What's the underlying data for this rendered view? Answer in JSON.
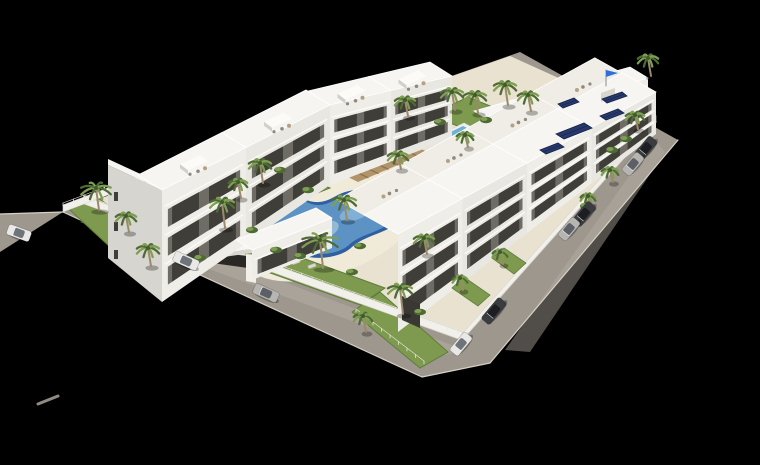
{
  "scene": {
    "canvas": {
      "w": 760,
      "h": 465
    },
    "palette": {
      "background": "#000000",
      "road": "#9e978e",
      "roadLight": "#b4ada3",
      "curb": "#d6d0c4",
      "deck": "#e9e2d1",
      "deckLight": "#f0ead9",
      "lawn": "#7e9a4f",
      "lawnDark": "#5f7c3c",
      "bldgTop": "#f6f5f1",
      "bldgFaceA": "#efede7",
      "bldgFaceB": "#e9e7e1",
      "bldgSide": "#d7d5cf",
      "recess": "#6e6c65",
      "window": "#3f3e39",
      "slab": "#fbfaf7",
      "capTop": "#fcfbf8",
      "capSide": "#d2d0ca",
      "wallWhite": "#f2f0ea",
      "wallEdge": "#d9d6cf",
      "poolRim": "#2e5fa3",
      "poolWater": "#5d93c4",
      "poolShallow": "#9cc0d6",
      "poolGlint": "#86b4d6",
      "smallPoolWater": "#6fb0d4",
      "smallPoolDeck": "#eef0ef",
      "wood": "#b2946a",
      "woodDark": "#8d7350",
      "palmDark": "#4e6b35",
      "palmLight": "#7f9e52",
      "palmCore": "#3f5a2c",
      "trunk": "#9b8a6a",
      "furnGray": "#8f8a80",
      "furnTan": "#b3a184",
      "lounger": "#ddd8cc",
      "loungerEdge": "#a8a297",
      "panel": "#27386b",
      "panelEdge": "#16224a",
      "flag": "#2f6fd6",
      "pole": "#8a8a8a",
      "carWhite": "#e8e8e6",
      "carSilver": "#b6b5b1",
      "carDark": "#3b3c3f",
      "cabinWhite": "#6f747a",
      "cabinSilver": "#5c6066",
      "cabinDark": "#1c1e22",
      "shadow": "rgba(0,0,0,0.28)",
      "gateShadow": "#2a2825",
      "garage": "#3a3833",
      "fence": "#e8e6df",
      "strayMark": "#908a82",
      "speck": "#cfcac2"
    },
    "ground": {
      "mainRoad": [
        [
          63,
          212
        ],
        [
          520,
          52
        ],
        [
          678,
          140
        ],
        [
          490,
          363
        ],
        [
          422,
          377
        ]
      ],
      "leftRoadExt": [
        [
          63,
          212
        ],
        [
          0,
          214
        ],
        [
          0,
          252
        ]
      ],
      "frontRoadSheen": [
        [
          80,
          222
        ],
        [
          445,
          355
        ],
        [
          465,
          350
        ],
        [
          100,
          213
        ]
      ],
      "rightRoadSheen": [
        [
          655,
          140
        ],
        [
          505,
          350
        ],
        [
          530,
          352
        ],
        [
          665,
          152
        ]
      ],
      "site": [
        [
          84,
          204
        ],
        [
          510,
          56
        ],
        [
          656,
          122
        ],
        [
          462,
          340
        ]
      ],
      "curbs": [
        [
          [
            63,
            212
          ],
          [
            422,
            377
          ]
        ],
        [
          [
            84,
            204
          ],
          [
            462,
            340
          ]
        ],
        [
          [
            678,
            140
          ],
          [
            490,
            363
          ]
        ],
        [
          [
            656,
            122
          ],
          [
            462,
            340
          ]
        ],
        [
          [
            422,
            377
          ],
          [
            490,
            363
          ]
        ],
        [
          [
            0,
            214
          ],
          [
            63,
            212
          ]
        ]
      ],
      "strayDash": [
        [
          38,
          404
        ],
        [
          58,
          396
        ]
      ],
      "speck": [
        157,
        281
      ]
    },
    "poolDeckEllipse": {
      "cx": 330,
      "cy": 226,
      "rx": 95,
      "ry": 48,
      "rot": -20
    },
    "mainPool": {
      "rimPath": "M 262,212 C 268,198 288,192 304,199 C 315,204 324,203 336,196 C 352,186 382,188 396,200 C 406,209 402,222 388,229 C 376,235 362,238 352,247 C 342,257 318,261 300,255 C 282,249 256,232 262,212 Z",
      "waterScale": 0.88,
      "center": [
        330,
        226
      ],
      "shallow": {
        "cx": 310,
        "cy": 234,
        "rx": 30,
        "ry": 11,
        "rot": -18
      },
      "glint": {
        "cx": 355,
        "cy": 213,
        "rx": 16,
        "ry": 7,
        "rot": -18
      }
    },
    "smallPool": {
      "deck": [
        [
          431,
          139
        ],
        [
          464,
          123
        ],
        [
          489,
          136
        ],
        [
          456,
          152
        ]
      ],
      "water": [
        [
          436,
          139
        ],
        [
          463,
          126
        ],
        [
          484,
          136
        ],
        [
          457,
          149
        ]
      ]
    },
    "woodDeck": {
      "quad": [
        [
          330,
          168
        ],
        [
          400,
          140
        ],
        [
          428,
          152
        ],
        [
          358,
          182
        ]
      ],
      "stripes": 7
    },
    "pavilion": [
      [
        430,
        155
      ],
      [
        452,
        146
      ],
      [
        462,
        153
      ],
      [
        440,
        162
      ]
    ],
    "lawns": [
      [
        [
          70,
          210
        ],
        [
          162,
          295
        ],
        [
          192,
          268
        ],
        [
          92,
          193
        ]
      ],
      [
        [
          262,
          270
        ],
        [
          360,
          305
        ],
        [
          385,
          288
        ],
        [
          286,
          252
        ]
      ],
      [
        [
          352,
          312
        ],
        [
          420,
          368
        ],
        [
          448,
          352
        ],
        [
          380,
          292
        ]
      ],
      [
        [
          215,
          235
        ],
        [
          252,
          258
        ],
        [
          272,
          244
        ],
        [
          238,
          218
        ]
      ],
      [
        [
          248,
          180
        ],
        [
          300,
          200
        ],
        [
          330,
          188
        ],
        [
          278,
          166
        ]
      ],
      [
        [
          430,
          115
        ],
        [
          480,
          135
        ],
        [
          520,
          118
        ],
        [
          468,
          97
        ]
      ],
      [
        [
          600,
          150
        ],
        [
          650,
          128
        ],
        [
          640,
          120
        ],
        [
          592,
          142
        ]
      ]
    ],
    "patioLawns": [
      [
        [
          452,
          288
        ],
        [
          478,
          306
        ],
        [
          490,
          295
        ],
        [
          464,
          277
        ]
      ],
      [
        [
          492,
          258
        ],
        [
          514,
          274
        ],
        [
          526,
          263
        ],
        [
          504,
          248
        ]
      ]
    ],
    "walls": [
      {
        "quad": [
          [
            84,
            204
          ],
          [
            205,
            248
          ],
          [
            205,
            240
          ],
          [
            84,
            196
          ]
        ]
      },
      {
        "quad": [
          [
            258,
            267
          ],
          [
            462,
            340
          ],
          [
            462,
            332
          ],
          [
            258,
            259
          ]
        ]
      },
      {
        "quad": [
          [
            656,
            122
          ],
          [
            462,
            340
          ],
          [
            462,
            334
          ],
          [
            656,
            116
          ]
        ]
      },
      {
        "quad": [
          [
            63,
            212
          ],
          [
            200,
            160
          ],
          [
            200,
            153
          ],
          [
            63,
            205
          ]
        ]
      }
    ],
    "fences": [
      {
        "from": [
          84,
          198
        ],
        "to": [
          203,
          242
        ],
        "n": 12
      },
      {
        "from": [
          260,
          261
        ],
        "to": [
          458,
          333
        ],
        "n": 19
      },
      {
        "from": [
          63,
          206
        ],
        "to": [
          198,
          155
        ],
        "n": 13
      },
      {
        "from": [
          356,
          312
        ],
        "to": [
          424,
          364
        ],
        "n": 8
      }
    ],
    "entranceGate": {
      "shadow": [
        [
          212,
          252
        ],
        [
          248,
          256
        ],
        [
          248,
          268
        ],
        [
          212,
          263
        ]
      ],
      "rightLeg": [
        [
          246,
          254
        ],
        [
          256,
          255
        ],
        [
          256,
          283
        ],
        [
          246,
          281
        ]
      ],
      "leftLeg": [
        [
          206,
          248
        ],
        [
          211,
          248
        ],
        [
          211,
          266
        ],
        [
          206,
          265
        ]
      ],
      "roofTop": [
        [
          204,
          242
        ],
        [
          252,
          236
        ],
        [
          265,
          247
        ],
        [
          217,
          254
        ]
      ],
      "roofEdge": [
        [
          217,
          254
        ],
        [
          265,
          247
        ],
        [
          265,
          251
        ],
        [
          217,
          258
        ]
      ],
      "vents": [
        [
          231,
          246
        ],
        [
          241,
          244
        ]
      ]
    },
    "leftGableEnd": {
      "wall": [
        [
          108,
          258
        ],
        [
          162,
          302
        ],
        [
          162,
          190
        ],
        [
          108,
          165
        ]
      ],
      "roofSliver": [
        [
          108,
          165
        ],
        [
          162,
          190
        ],
        [
          162,
          184
        ],
        [
          108,
          159
        ]
      ],
      "windows": [
        [
          114,
          192
        ],
        [
          114,
          222
        ],
        [
          114,
          250
        ]
      ]
    },
    "rows": [
      {
        "name": "apartment-row-back",
        "x0": 492,
        "y0": 172,
        "x1": 648,
        "y1": 112,
        "h0": 50,
        "h1": 34,
        "sections": 3,
        "rdx": -18,
        "rdy": -11,
        "floors": 2,
        "gabled": true,
        "terrace": false
      },
      {
        "name": "apartment-row-left-a",
        "x0": 162,
        "y0": 302,
        "x1": 330,
        "y1": 185,
        "h0": 112,
        "h1": 80,
        "sections": 2,
        "rdx": -24,
        "rdy": -15,
        "floors": 3,
        "gabled": true,
        "terrace": false
      },
      {
        "name": "apartment-row-left-b",
        "x0": 330,
        "y0": 185,
        "x1": 452,
        "y1": 138,
        "h0": 80,
        "h1": 62,
        "sections": 2,
        "rdx": -22,
        "rdy": -14,
        "floors": 3,
        "gabled": true,
        "terrace": false
      },
      {
        "name": "front-low-block",
        "x0": 252,
        "y0": 280,
        "x1": 332,
        "y1": 248,
        "h0": 30,
        "h1": 30,
        "sections": 1,
        "rdx": -16,
        "rdy": -10,
        "floors": 1,
        "gabled": false,
        "terrace": false
      },
      {
        "name": "apartment-row-right",
        "x0": 398,
        "y0": 332,
        "x1": 656,
        "y1": 134,
        "h0": 98,
        "h1": 42,
        "sections": 4,
        "rdx": -34,
        "rdy": -19,
        "floors": 3,
        "gabled": false,
        "terrace": true
      }
    ],
    "garageDoor": [
      [
        402,
        320
      ],
      [
        420,
        328
      ],
      [
        420,
        304
      ],
      [
        402,
        296
      ]
    ],
    "flagTower": {
      "top": [
        [
          597,
          89
        ],
        [
          611,
          84
        ],
        [
          615,
          88
        ],
        [
          601,
          93
        ]
      ],
      "front": [
        [
          601,
          93
        ],
        [
          615,
          88
        ],
        [
          615,
          97
        ],
        [
          601,
          102
        ]
      ],
      "pole": [
        [
          606,
          86
        ],
        [
          606,
          70
        ]
      ],
      "flag": [
        [
          606,
          70
        ],
        [
          618,
          73
        ],
        [
          606,
          77
        ]
      ]
    },
    "solarPanels": [
      [
        [
          556,
          134
        ],
        [
          584,
          123
        ],
        [
          592,
          128
        ],
        [
          564,
          139
        ]
      ],
      [
        [
          540,
          150
        ],
        [
          558,
          143
        ],
        [
          564,
          147
        ],
        [
          546,
          154
        ]
      ],
      [
        [
          600,
          116
        ],
        [
          618,
          109
        ],
        [
          624,
          113
        ],
        [
          606,
          120
        ]
      ],
      [
        [
          602,
          99
        ],
        [
          622,
          92
        ],
        [
          627,
          96
        ],
        [
          607,
          103
        ]
      ],
      [
        [
          558,
          104
        ],
        [
          574,
          98
        ],
        [
          579,
          102
        ],
        [
          563,
          108
        ]
      ]
    ],
    "palms": [
      {
        "x": 96,
        "y": 188,
        "r": 16,
        "t": 22
      },
      {
        "x": 126,
        "y": 216,
        "r": 11,
        "t": 16
      },
      {
        "x": 148,
        "y": 248,
        "r": 12,
        "t": 18
      },
      {
        "x": 222,
        "y": 202,
        "r": 13,
        "t": 26
      },
      {
        "x": 238,
        "y": 182,
        "r": 10,
        "t": 16
      },
      {
        "x": 260,
        "y": 163,
        "r": 12,
        "t": 20
      },
      {
        "x": 320,
        "y": 240,
        "r": 19,
        "t": 28
      },
      {
        "x": 344,
        "y": 200,
        "r": 13,
        "t": 20
      },
      {
        "x": 398,
        "y": 155,
        "r": 11,
        "t": 14
      },
      {
        "x": 405,
        "y": 100,
        "r": 11,
        "t": 16
      },
      {
        "x": 452,
        "y": 92,
        "r": 12,
        "t": 18
      },
      {
        "x": 475,
        "y": 95,
        "r": 12,
        "t": 18
      },
      {
        "x": 505,
        "y": 85,
        "r": 12,
        "t": 20
      },
      {
        "x": 528,
        "y": 95,
        "r": 11,
        "t": 16
      },
      {
        "x": 465,
        "y": 135,
        "r": 9,
        "t": 12
      },
      {
        "x": 635,
        "y": 115,
        "r": 10,
        "t": 14
      },
      {
        "x": 610,
        "y": 170,
        "r": 9,
        "t": 12
      },
      {
        "x": 588,
        "y": 196,
        "r": 8,
        "t": 11
      },
      {
        "x": 400,
        "y": 288,
        "r": 13,
        "t": 26
      },
      {
        "x": 363,
        "y": 316,
        "r": 10,
        "t": 16
      },
      {
        "x": 424,
        "y": 238,
        "r": 11,
        "t": 16
      },
      {
        "x": 460,
        "y": 278,
        "r": 8,
        "t": 12
      },
      {
        "x": 500,
        "y": 252,
        "r": 8,
        "t": 12
      },
      {
        "x": 648,
        "y": 58,
        "r": 11,
        "t": 18
      }
    ],
    "bushes": [
      [
        200,
        258
      ],
      [
        276,
        250
      ],
      [
        300,
        256
      ],
      [
        352,
        272
      ],
      [
        420,
        312
      ],
      [
        586,
        206
      ],
      [
        612,
        150
      ],
      [
        626,
        139
      ],
      [
        280,
        170
      ],
      [
        308,
        190
      ],
      [
        360,
        246
      ],
      [
        440,
        122
      ],
      [
        486,
        120
      ],
      [
        252,
        230
      ]
    ],
    "loungers": [
      [
        262,
        206
      ],
      [
        274,
        197
      ],
      [
        402,
        177
      ],
      [
        392,
        186
      ],
      [
        296,
        262
      ],
      [
        312,
        266
      ],
      [
        458,
        149
      ],
      [
        466,
        153
      ],
      [
        474,
        157
      ],
      [
        482,
        161
      ]
    ],
    "cars": [
      {
        "x": 19,
        "y": 233,
        "deg": 20,
        "len": 24,
        "color": "carWhite",
        "cabin": "cabinWhite"
      },
      {
        "x": 186,
        "y": 261,
        "deg": 24,
        "len": 26,
        "color": "carWhite",
        "cabin": "cabinWhite"
      },
      {
        "x": 266,
        "y": 293,
        "deg": 24,
        "len": 26,
        "color": "carSilver",
        "cabin": "cabinSilver"
      },
      {
        "x": 494,
        "y": 311,
        "deg": -50,
        "len": 28,
        "color": "carDark",
        "cabin": "cabinDark"
      },
      {
        "x": 461,
        "y": 344,
        "deg": -50,
        "len": 24,
        "color": "carWhite",
        "cabin": "cabinWhite"
      },
      {
        "x": 646,
        "y": 148,
        "deg": -50,
        "len": 24,
        "color": "carDark",
        "cabin": "cabinDark"
      },
      {
        "x": 633,
        "y": 164,
        "deg": -50,
        "len": 24,
        "color": "carSilver",
        "cabin": "cabinSilver"
      },
      {
        "x": 584,
        "y": 214,
        "deg": -50,
        "len": 26,
        "color": "carDark",
        "cabin": "cabinDark"
      },
      {
        "x": 569,
        "y": 229,
        "deg": -50,
        "len": 24,
        "color": "carSilver",
        "cabin": "cabinSilver"
      }
    ]
  }
}
